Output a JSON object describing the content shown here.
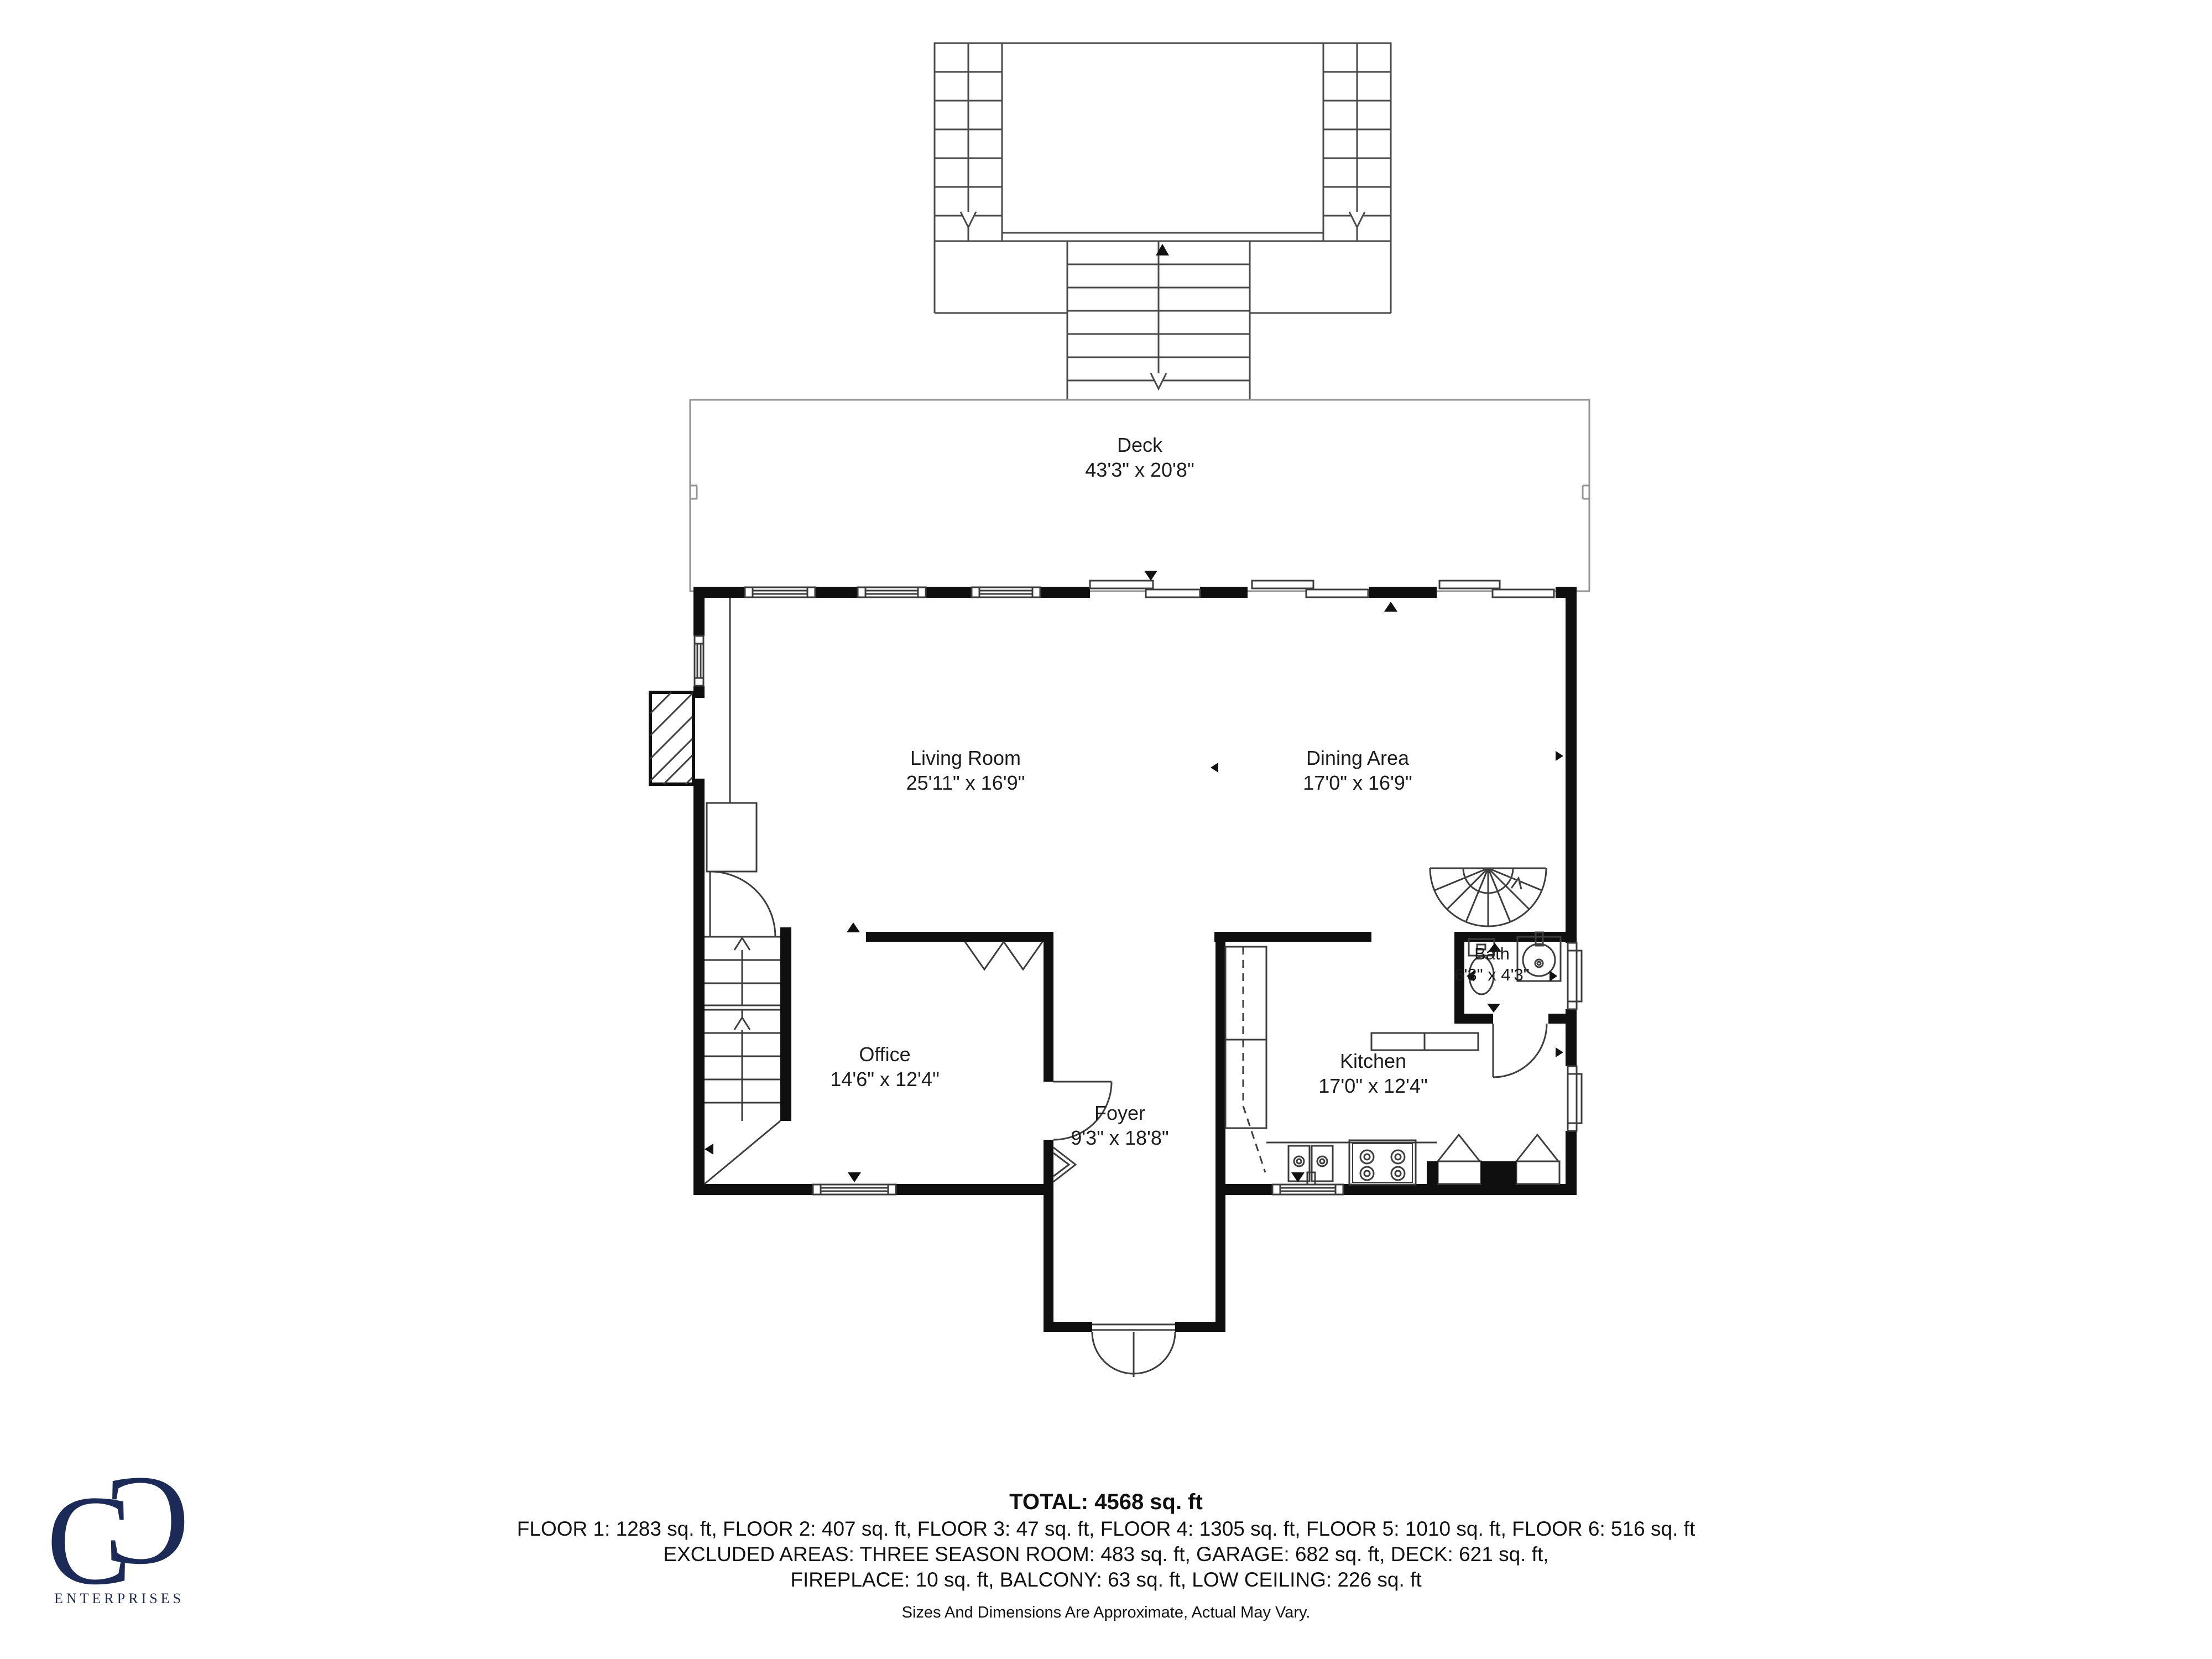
{
  "logo": {
    "monogram_left": "C",
    "monogram_right": "C",
    "company": "ENTERPRISES",
    "color": "#1b2a57"
  },
  "rooms": [
    {
      "id": "deck",
      "name": "Deck",
      "dims": "43'3\" x 20'8\""
    },
    {
      "id": "living-room",
      "name": "Living Room",
      "dims": "25'11\" x 16'9\""
    },
    {
      "id": "dining-area",
      "name": "Dining Area",
      "dims": "17'0\" x 16'9\""
    },
    {
      "id": "office",
      "name": "Office",
      "dims": "14'6\" x 12'4\""
    },
    {
      "id": "foyer",
      "name": "Foyer",
      "dims": "9'3\" x 18'8\""
    },
    {
      "id": "kitchen",
      "name": "Kitchen",
      "dims": "17'0\" x 12'4\""
    },
    {
      "id": "bath",
      "name": "Bath",
      "dims": "6'3\" x 4'3\""
    }
  ],
  "summary": {
    "total": "TOTAL: 4568 sq. ft",
    "floors": "FLOOR 1: 1283 sq. ft, FLOOR 2: 407 sq. ft, FLOOR 3: 47 sq. ft, FLOOR 4: 1305 sq. ft, FLOOR 5: 1010 sq. ft, FLOOR 6: 516 sq. ft",
    "excluded_1": "EXCLUDED AREAS: THREE SEASON ROOM: 483 sq. ft, GARAGE: 682 sq. ft, DECK: 621 sq. ft,",
    "excluded_2": "FIREPLACE: 10 sq. ft, BALCONY: 63 sq. ft, LOW CEILING: 226 sq. ft",
    "disclaimer": "Sizes And Dimensions Are Approximate, Actual May Vary."
  },
  "colors": {
    "wall": "#0f0f0f",
    "thin_line": "#3d3d3d",
    "stair_line": "#4a4a4a",
    "deck_line": "#939393",
    "text": "#1c1c1c",
    "logo_navy": "#1b2a57"
  }
}
